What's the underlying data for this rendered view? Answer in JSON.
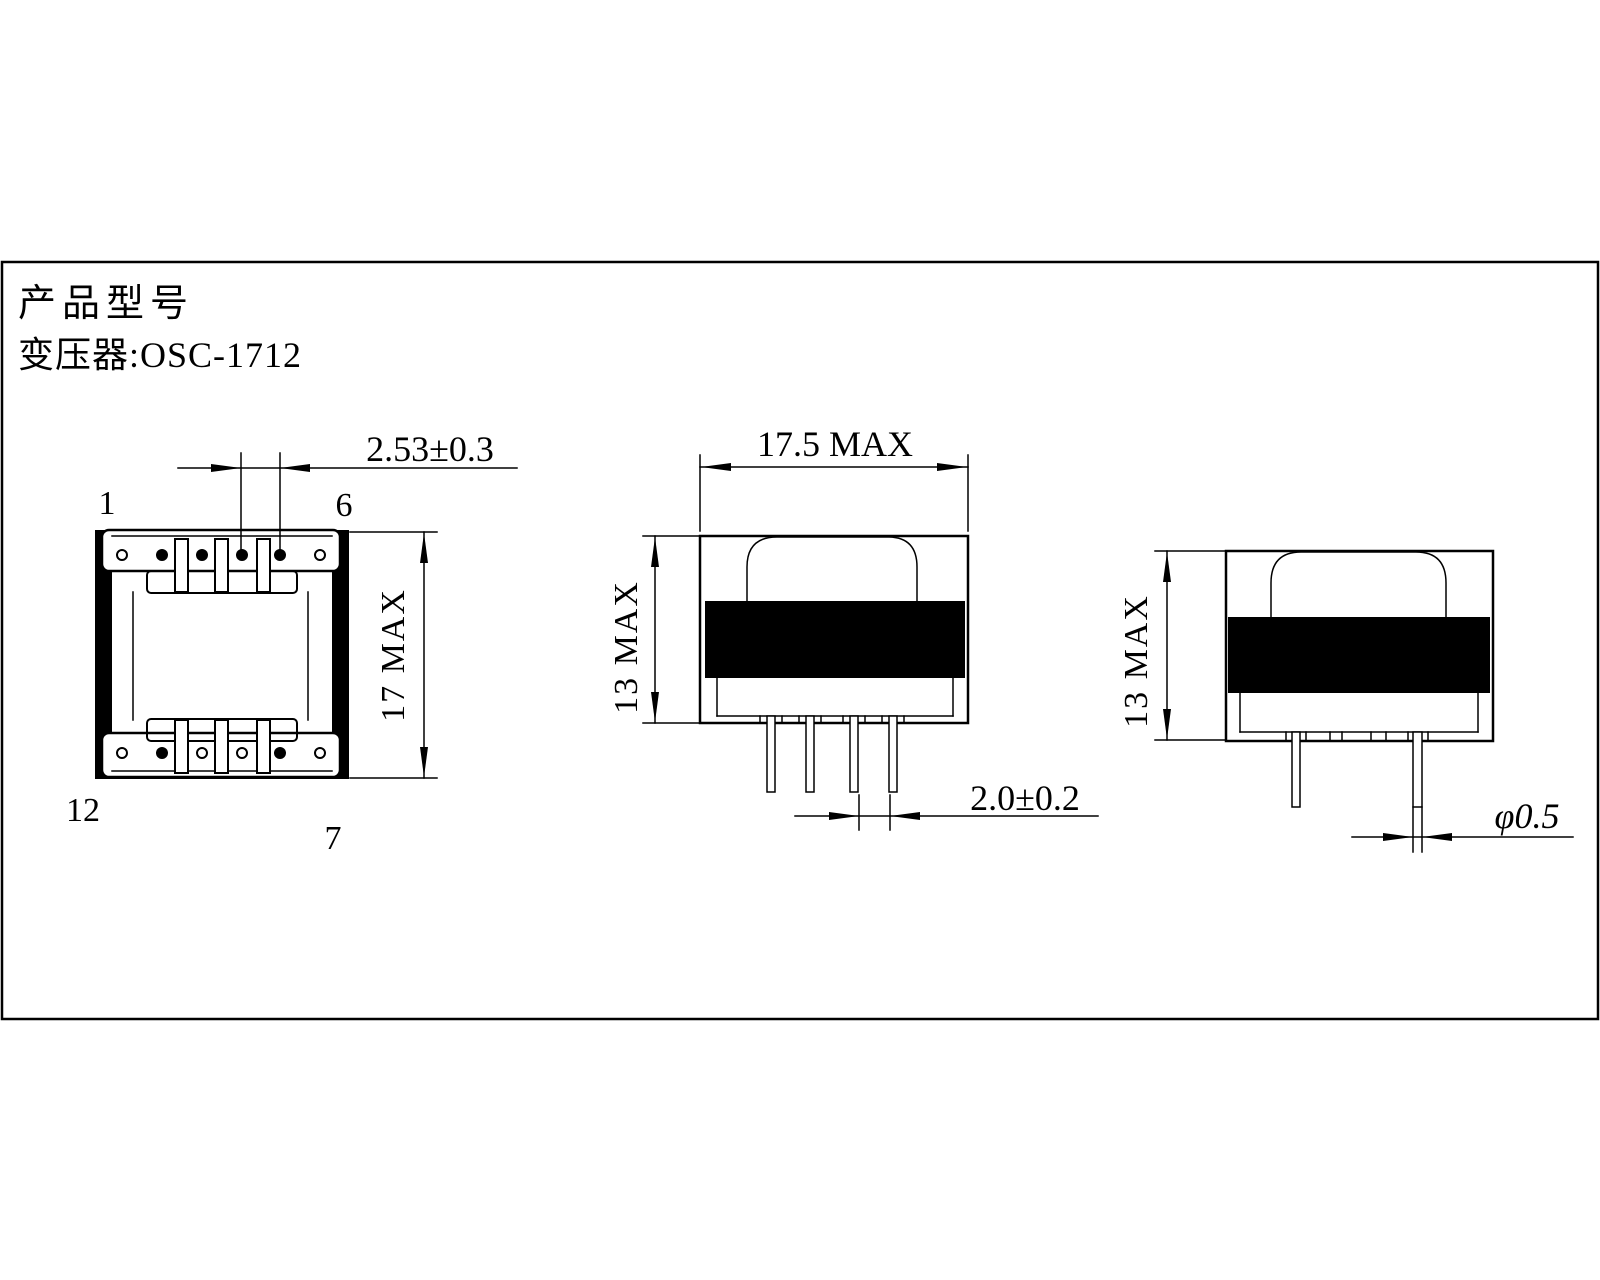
{
  "colors": {
    "ink": "#000000",
    "background": "#ffffff"
  },
  "title": {
    "line1": "产品型号",
    "line2": "变压器:OSC-1712"
  },
  "top_view": {
    "pin_labels": {
      "p1": "1",
      "p6": "6",
      "p12": "12",
      "p7": "7"
    },
    "dim_pin_pitch": "2.53±0.3",
    "dim_height": "17 MAX"
  },
  "front_view": {
    "dim_width": "17.5 MAX",
    "dim_height": "13 MAX",
    "dim_pin_spacing": "2.0±0.2"
  },
  "side_view": {
    "dim_height": "13 MAX",
    "dim_pin_diameter": "φ0.5"
  }
}
